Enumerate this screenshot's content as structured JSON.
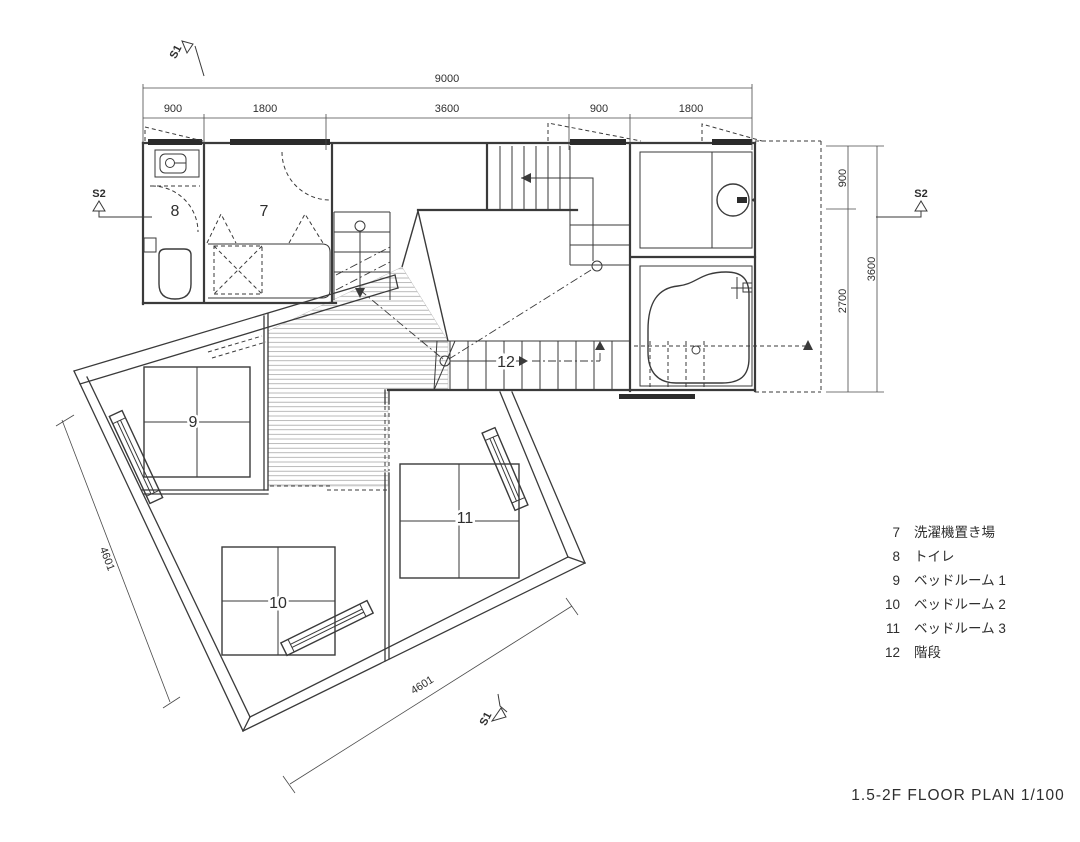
{
  "title": "1.5-2F FLOOR PLAN 1/100",
  "section_markers": {
    "s1": "S1",
    "s2": "S2"
  },
  "dimensions": {
    "top_total": "9000",
    "top_segments": [
      "900",
      "1800",
      "3600",
      "900",
      "1800"
    ],
    "right_segments": [
      "900",
      "2700"
    ],
    "right_total": "3600",
    "left_wall": "4601",
    "bottom_wall": "4601"
  },
  "rooms": {
    "washer": "7",
    "toilet": "8",
    "bedroom1": "9",
    "bedroom2": "10",
    "bedroom3": "11",
    "stairs": "12"
  },
  "legend": {
    "items": [
      {
        "number": "7",
        "label": "洗濯機置き場"
      },
      {
        "number": "8",
        "label": "トイレ"
      },
      {
        "number": "9",
        "label": "ベッドルーム 1"
      },
      {
        "number": "10",
        "label": "ベッドルーム 2"
      },
      {
        "number": "11",
        "label": "ベッドルーム 3"
      },
      {
        "number": "12",
        "label": "階段"
      }
    ]
  },
  "colors": {
    "background": "#ffffff",
    "line": "#3a3a3a",
    "dimension_line": "#4a4a4a",
    "hatch": "#9a9a9a",
    "window_bar": "#2b2b2b"
  }
}
